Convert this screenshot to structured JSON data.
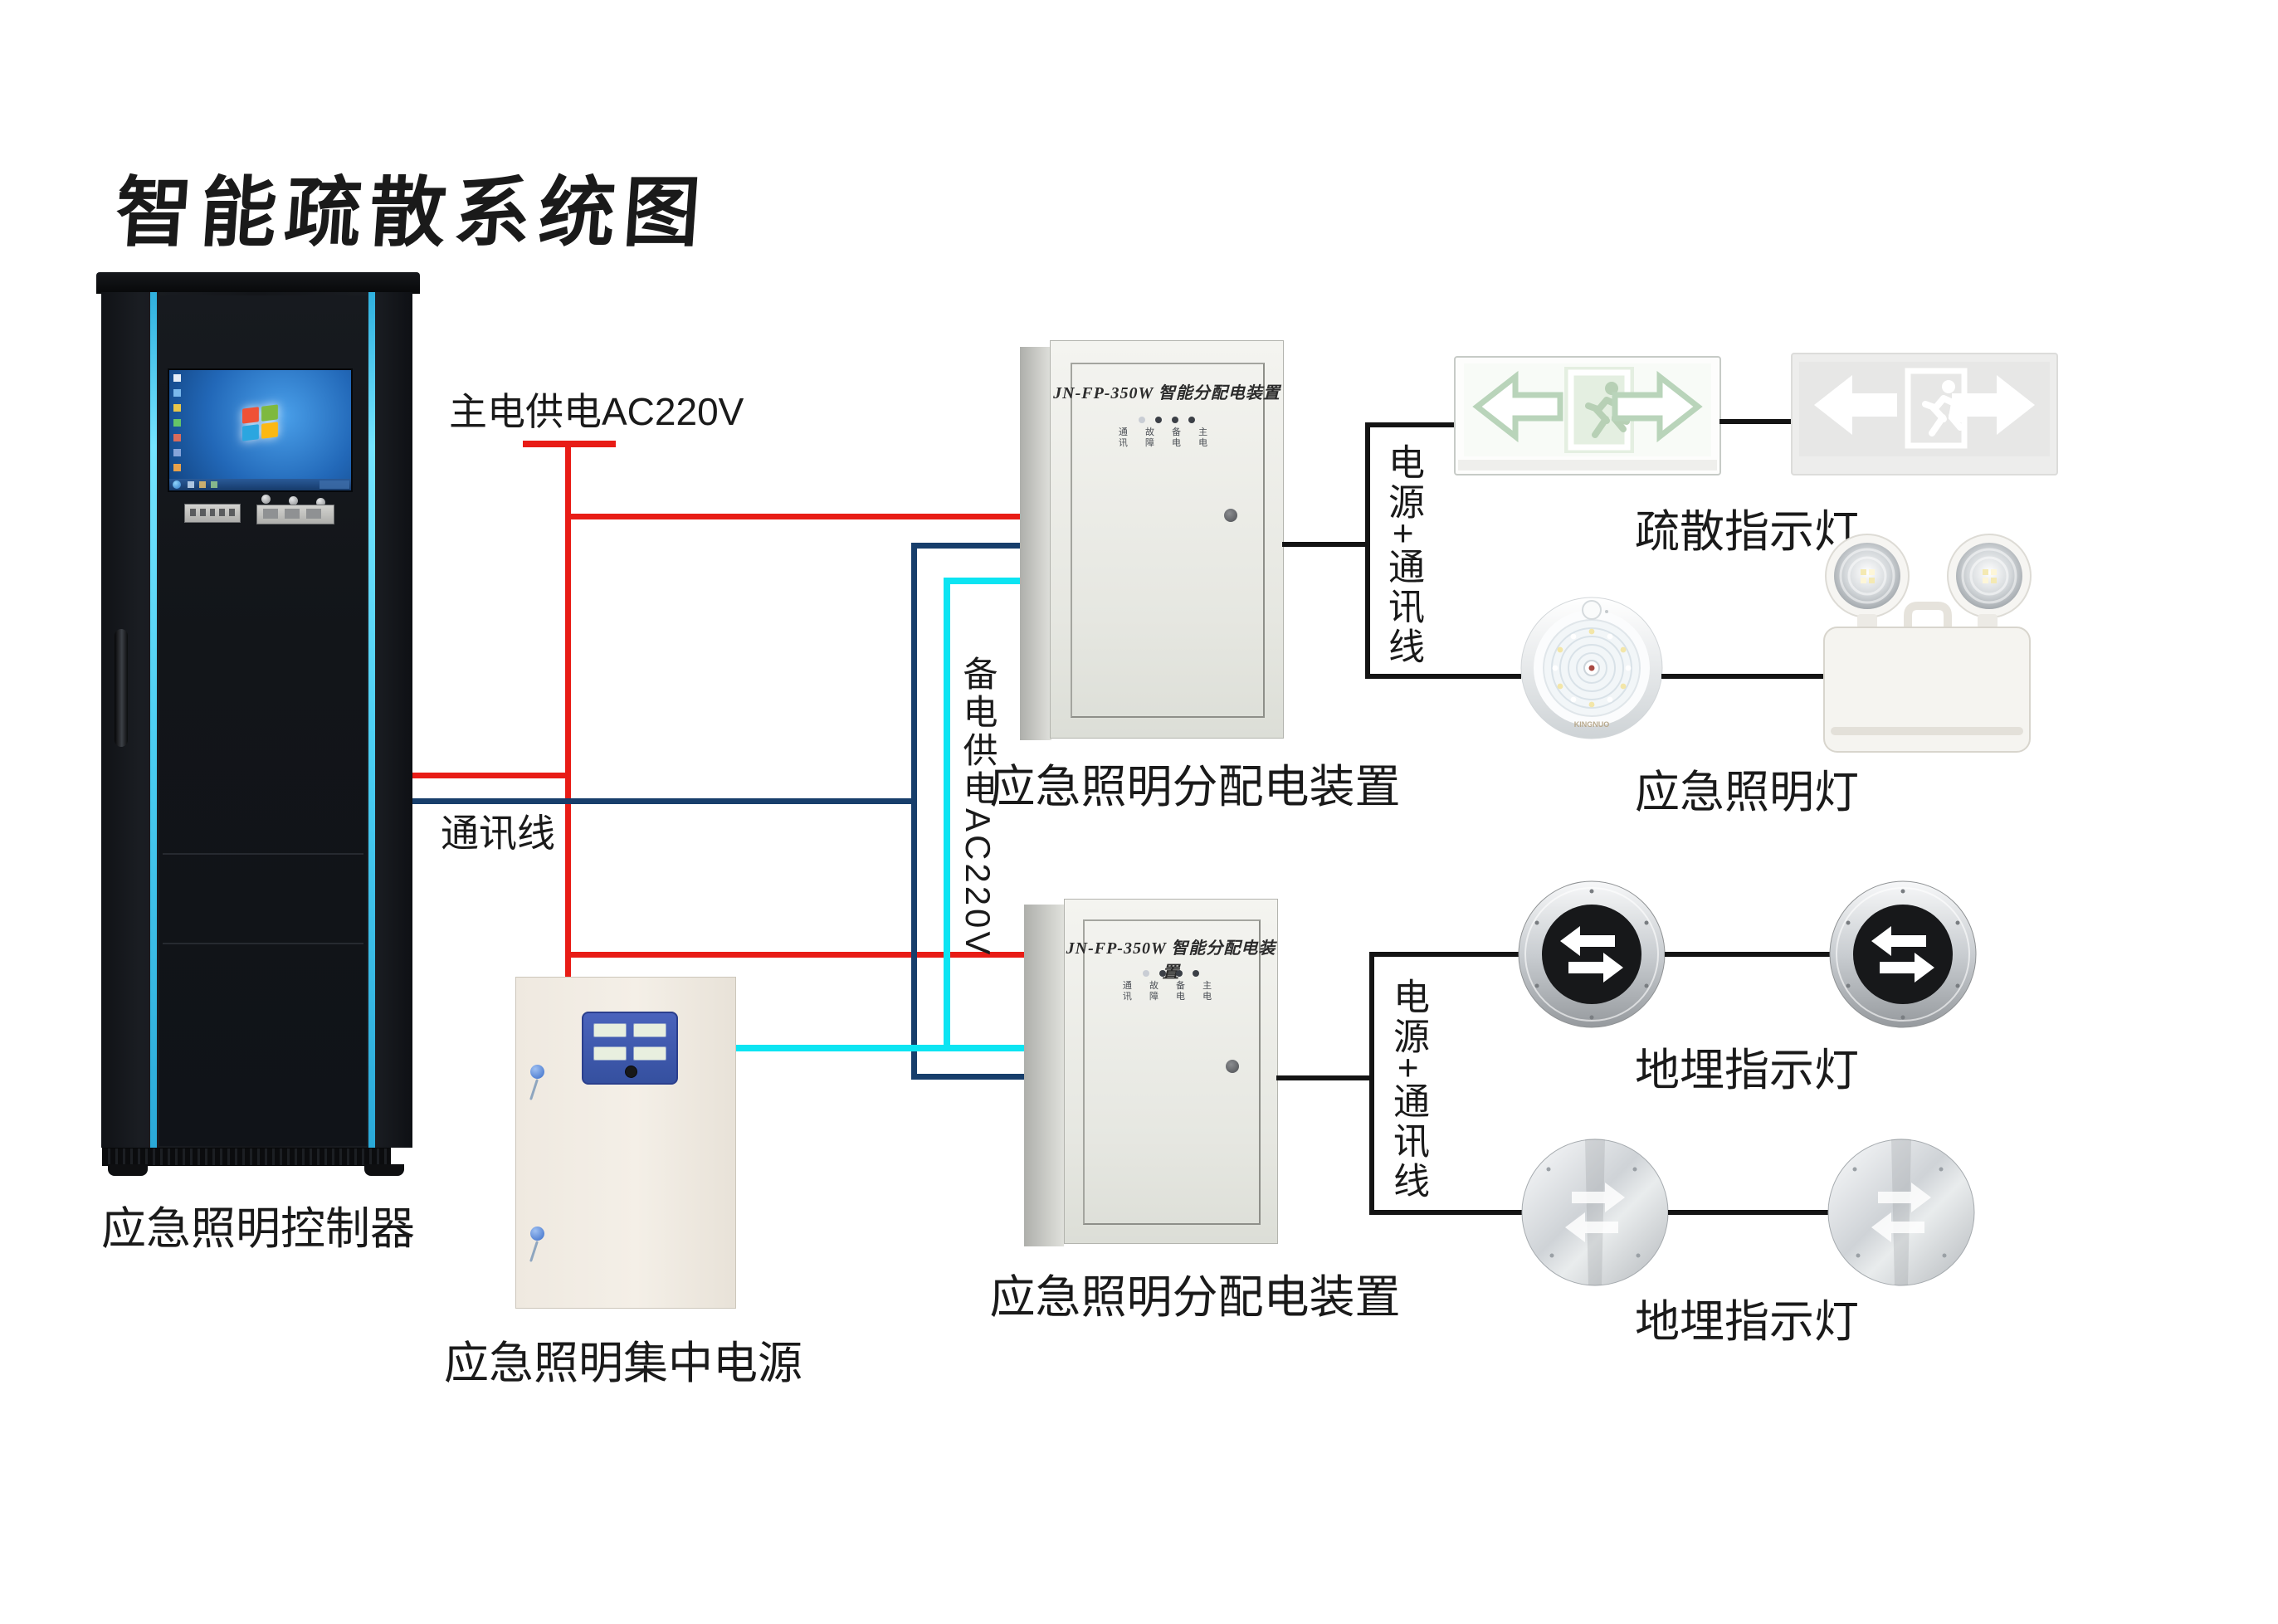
{
  "title": "智能疏散系统图",
  "cabinet": {
    "label": "应急照明控制器"
  },
  "power_supply": {
    "label": "应急照明集中电源"
  },
  "wire_labels": {
    "main_power": "主电供电AC220V",
    "comm": "通讯线",
    "backup_power": "备电供电AC220V",
    "power_comm_1": "电源+通讯线",
    "power_comm_2": "电源+通讯线"
  },
  "colors": {
    "main_power_wire": "#e81c16",
    "comm_wire": "#173e6b",
    "backup_power_wire": "#0ce4f2",
    "device_wire": "#141414",
    "cabinet_strip": "#49cdf2"
  },
  "distribution_box_1": {
    "header": "JN-FP-350W 智能分配电装置",
    "indicator_row_1": "通 故 备 主",
    "indicator_row_2": "讯 障 电 电",
    "label": "应急照明分配电装置"
  },
  "distribution_box_2": {
    "header": "JN-FP-350W 智能分配电装置",
    "indicator_row_1": "通 故 备 主",
    "indicator_row_2": "讯 障 电 电",
    "label": "应急照明分配电装置"
  },
  "devices": {
    "exit_sign_label": "疏散指示灯",
    "emergency_light_label": "应急照明灯",
    "buried_light_label_1": "地埋指示灯",
    "buried_light_label_2": "地埋指示灯",
    "dome_light_brand": "KINGNUO"
  }
}
